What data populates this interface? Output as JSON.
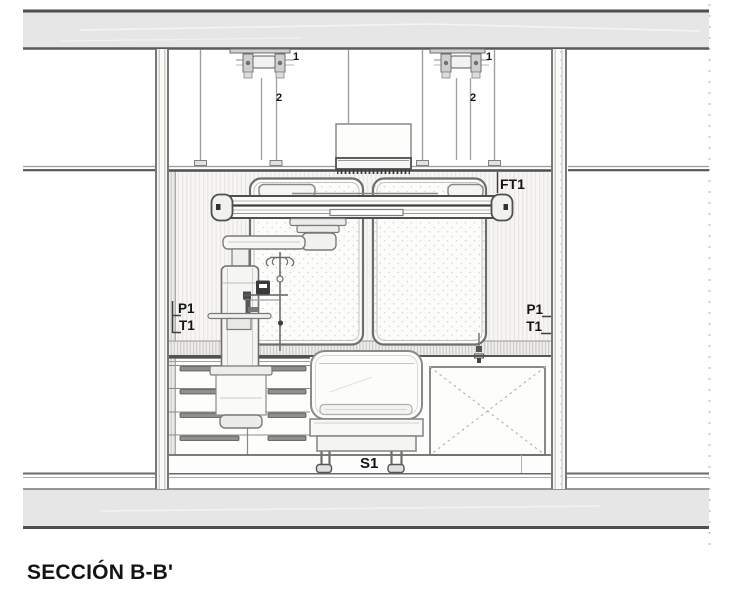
{
  "page": {
    "title_block": {
      "section_title": "SECCIÓN B-B'"
    },
    "annotations": {
      "mount_left": {
        "ref_upper": "1",
        "ref_lower": "2"
      },
      "mount_right": {
        "ref_upper": "1",
        "ref_lower": "2"
      },
      "false_ceiling_tag": "FT1",
      "left_wall": {
        "panel_tag": "P1",
        "trim_tag": "T1"
      },
      "right_wall": {
        "panel_tag": "P1",
        "trim_tag": "T1"
      },
      "bed_tag": "S1"
    },
    "colors": {
      "slab_fill": "#e6e6e6",
      "line_dark": "#4f4f4f",
      "line_mid": "#8a8a8a",
      "label": "#141414"
    }
  }
}
